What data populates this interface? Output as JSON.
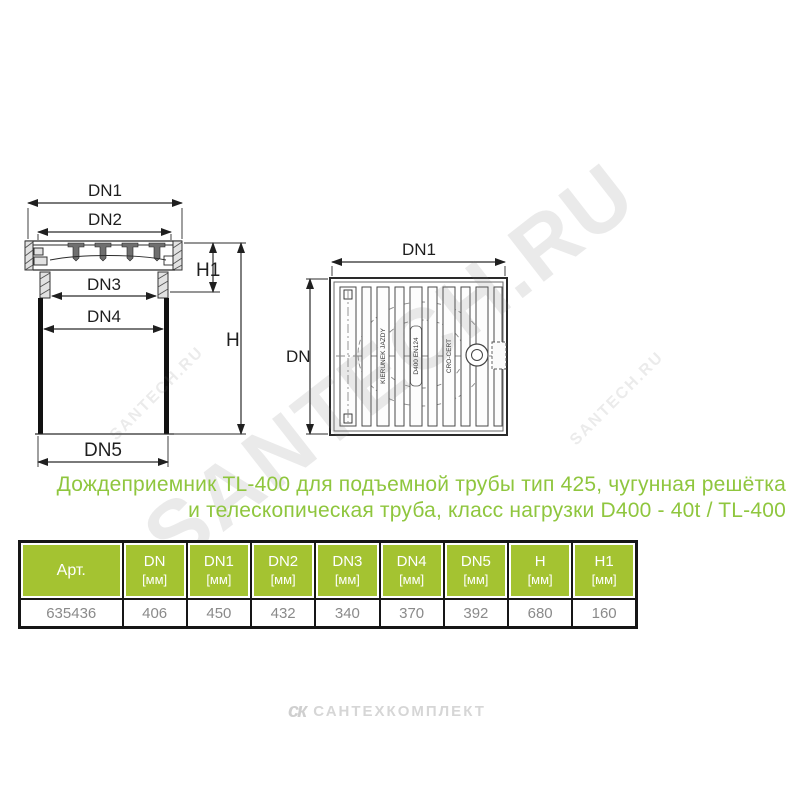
{
  "page": {
    "background": "#ffffff"
  },
  "title": {
    "line1": "Дождеприемник TL-400 для подъемной трубы тип 425, чугунная решётка",
    "line2": "и телескопическая труба, класс нагрузки D400 - 40t / TL-400",
    "color": "#8fc63e"
  },
  "drawings": {
    "side_view": {
      "labels": {
        "dn1": "DN1",
        "dn2": "DN2",
        "dn3": "DN3",
        "dn4": "DN4",
        "dn5": "DN5",
        "h": "H",
        "h1": "H1"
      }
    },
    "top_view": {
      "labels": {
        "dn1": "DN1",
        "dn": "DN"
      },
      "grate_markings": {
        "direction": "KIERUNEK JAZDY",
        "load_class": "D400 EN124",
        "cert": "CRO-CERT"
      }
    }
  },
  "table": {
    "header_bg": "#a4c331",
    "header_text_color": "#ffffff",
    "value_text_color": "#8a8a8a",
    "columns": [
      {
        "label": "Арт.",
        "unit": ""
      },
      {
        "label": "DN",
        "unit": "[мм]"
      },
      {
        "label": "DN1",
        "unit": "[мм]"
      },
      {
        "label": "DN2",
        "unit": "[мм]"
      },
      {
        "label": "DN3",
        "unit": "[мм]"
      },
      {
        "label": "DN4",
        "unit": "[мм]"
      },
      {
        "label": "DN5",
        "unit": "[мм]"
      },
      {
        "label": "H",
        "unit": "[мм]"
      },
      {
        "label": "H1",
        "unit": "[мм]"
      }
    ],
    "rows": [
      [
        "635436",
        "406",
        "450",
        "432",
        "340",
        "370",
        "392",
        "680",
        "160"
      ]
    ]
  },
  "watermarks": {
    "large": "SANTECH.RU",
    "small_left": "SANTECH.RU",
    "small_right": "SANTECH.RU"
  },
  "footer": {
    "logo_glyph": "ск",
    "logo_text": "САНТЕХКОМПЛЕКТ"
  }
}
